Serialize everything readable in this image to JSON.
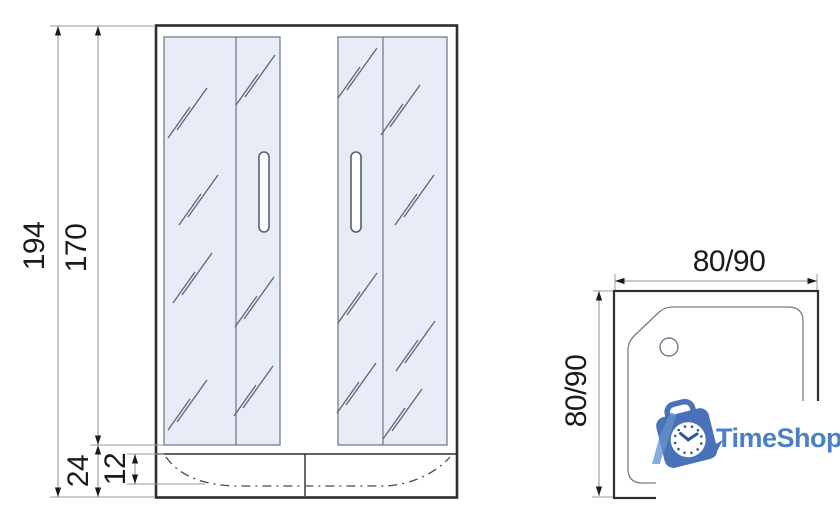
{
  "colors": {
    "line_main": "#2e2e31",
    "line_thin": "#767c8e",
    "line_dim": "#8f8f8f",
    "line_ext": "#9a9a9a",
    "line_dash": "#4a4a4a",
    "hatch": "#5d6578",
    "dim_text": "#1b1b1b",
    "glass_fill": "#e8ecf6",
    "handle_stroke": "#5a5f6b",
    "arrow": "#1b1b1b",
    "brand_blue": "#4c80c6",
    "brand_blue_dark": "#4a72ba",
    "brand_blue_light": "#85aede",
    "clock_mark": "#2f55a0"
  },
  "front_view": {
    "dim_total_height": "194",
    "dim_door_height": "170",
    "dim_tray_height": "24",
    "dim_tray_inner_height": "12"
  },
  "top_view": {
    "dim_width": "80/90",
    "dim_depth": "80/90"
  },
  "watermark": {
    "brand": "TimeShop"
  }
}
